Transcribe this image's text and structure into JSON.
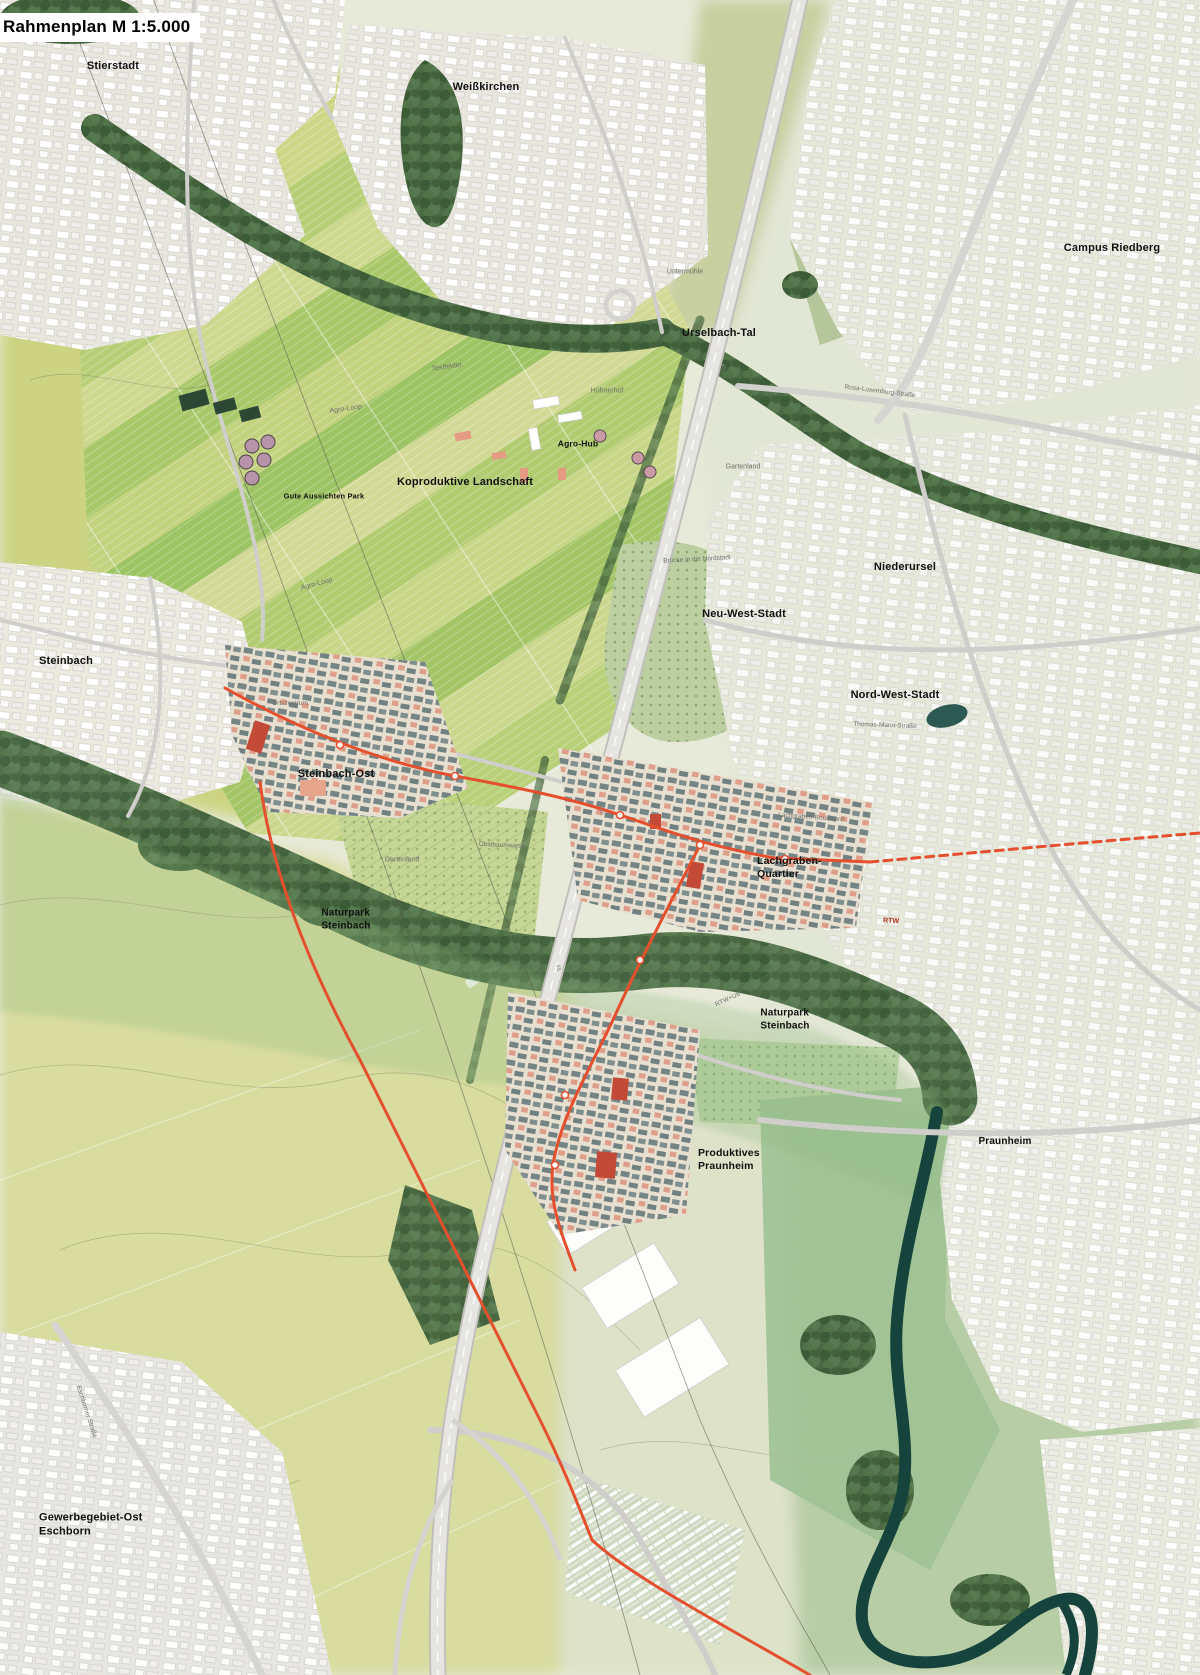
{
  "title": "Rahmenplan M 1:5.000",
  "colors": {
    "base": "#e8ead9",
    "fields_bright": "#b7cd72",
    "fields_pale": "#d6db9b",
    "urban": "#efeee8",
    "forest": "#4b6a43",
    "river": "#16443c",
    "rtw_line": "#e4502e",
    "quarter_building": "#6f7f80",
    "landmark_red": "#c24a37",
    "accent_salmon": "#dd9b85"
  },
  "map": {
    "labels": [
      {
        "id": "stierstadt",
        "kind": "place",
        "text": "Stierstadt",
        "x": 113,
        "y": 67,
        "size": 11
      },
      {
        "id": "weisskirchen",
        "kind": "place",
        "text": "Weißkirchen",
        "x": 486,
        "y": 88,
        "size": 11
      },
      {
        "id": "campus-riedberg",
        "kind": "place",
        "text": "Campus Riedberg",
        "x": 1112,
        "y": 249,
        "size": 11
      },
      {
        "id": "urselbach-tal",
        "kind": "place",
        "text": "Urselbach-Tal",
        "x": 719,
        "y": 334,
        "size": 11
      },
      {
        "id": "agro-hub",
        "kind": "place",
        "text": "Agro-Hub",
        "x": 578,
        "y": 444,
        "size": 8.5
      },
      {
        "id": "gute-aussichten-park",
        "kind": "place",
        "text": "Gute Aussichten Park",
        "x": 324,
        "y": 496,
        "size": 7.5
      },
      {
        "id": "koproduktive-landschaft",
        "kind": "place",
        "text": "Koproduktive Landschaft",
        "x": 465,
        "y": 483,
        "size": 11
      },
      {
        "id": "niederursel",
        "kind": "place",
        "text": "Niederursel",
        "x": 905,
        "y": 568,
        "size": 11
      },
      {
        "id": "neu-west-stadt",
        "kind": "place",
        "text": "Neu-West-Stadt",
        "x": 744,
        "y": 615,
        "size": 11
      },
      {
        "id": "nord-west-stadt",
        "kind": "place",
        "text": "Nord-West-Stadt",
        "x": 895,
        "y": 696,
        "size": 11
      },
      {
        "id": "steinbach",
        "kind": "place",
        "text": "Steinbach",
        "x": 66,
        "y": 662,
        "size": 11
      },
      {
        "id": "steinbach-ost",
        "kind": "place",
        "text": "Steinbach-Ost",
        "x": 336,
        "y": 775,
        "size": 11
      },
      {
        "id": "lachgraben-quartier",
        "kind": "place",
        "text": "Lachgraben-\nQuartier",
        "x": 757,
        "y": 868,
        "size": 10.5,
        "align": "left"
      },
      {
        "id": "naturpark-steinbach-1",
        "kind": "place",
        "text": "Naturpark\nSteinbach",
        "x": 346,
        "y": 920,
        "size": 10
      },
      {
        "id": "naturpark-steinbach-2",
        "kind": "place",
        "text": "Naturpark\nSteinbach",
        "x": 785,
        "y": 1020,
        "size": 10
      },
      {
        "id": "produktives-praunheim",
        "kind": "place",
        "text": "Produktives\nPraunheim",
        "x": 698,
        "y": 1160,
        "size": 10.5,
        "align": "left"
      },
      {
        "id": "praunheim",
        "kind": "place",
        "text": "Praunheim",
        "x": 1005,
        "y": 1142,
        "size": 10
      },
      {
        "id": "gewerbegebiet-ost-eschborn",
        "kind": "place",
        "text": "Gewerbegebiet-Ost\nEschborn",
        "x": 39,
        "y": 1525,
        "size": 11,
        "align": "left"
      },
      {
        "id": "untermuehle",
        "kind": "street",
        "text": "Untermühle",
        "x": 685,
        "y": 273,
        "size": 7
      },
      {
        "id": "agro-loop-1",
        "kind": "street",
        "text": "Agro-Loop",
        "x": 346,
        "y": 410,
        "size": 7,
        "rot": -8
      },
      {
        "id": "agro-loop-2",
        "kind": "street",
        "text": "Agro-Loop",
        "x": 317,
        "y": 585,
        "size": 7,
        "rot": -15
      },
      {
        "id": "testfelder",
        "kind": "street",
        "text": "Testfelder",
        "x": 447,
        "y": 368,
        "size": 7,
        "rot": -8
      },
      {
        "id": "huehnerhof",
        "kind": "street",
        "text": "Hühnerhof",
        "x": 607,
        "y": 392,
        "size": 7
      },
      {
        "id": "rosa-luxemburg-strasse",
        "kind": "street",
        "text": "Rosa-Luxemburg-Straße",
        "x": 880,
        "y": 392,
        "size": 6.5,
        "rot": 7
      },
      {
        "id": "bruecke-nordstadt",
        "kind": "street",
        "text": "Brücke in die Nordstadt",
        "x": 697,
        "y": 560,
        "size": 6.5,
        "rot": -3
      },
      {
        "id": "thomas-mann-strasse",
        "kind": "street",
        "text": "Thomas-Mann-Straße",
        "x": 885,
        "y": 726,
        "size": 6.5,
        "rot": 2
      },
      {
        "id": "gartenland-1",
        "kind": "street",
        "text": "Gartenland",
        "x": 402,
        "y": 861,
        "size": 7
      },
      {
        "id": "gartenland-2",
        "kind": "street",
        "text": "Gartenland",
        "x": 743,
        "y": 468,
        "size": 7
      },
      {
        "id": "obstbaumwiese",
        "kind": "street",
        "text": "Obstbaumwiese",
        "x": 502,
        "y": 846,
        "size": 6.5,
        "rot": 3
      },
      {
        "id": "lachgraben-boulevard",
        "kind": "street",
        "text": "Lachgraben-Boulevard",
        "x": 811,
        "y": 818,
        "size": 6.5,
        "rot": 4
      },
      {
        "id": "ortszentrum",
        "kind": "street",
        "text": "Ortszentrum",
        "x": 290,
        "y": 704,
        "size": 6.5
      },
      {
        "id": "eschborner-strasse",
        "kind": "street",
        "text": "Eschborner Straße",
        "x": 86,
        "y": 1412,
        "size": 6.5,
        "rot": 72
      },
      {
        "id": "rtw-u6",
        "kind": "street",
        "text": "RTW+U6",
        "x": 728,
        "y": 1000,
        "size": 6.5,
        "rot": -25
      },
      {
        "id": "rtw",
        "kind": "street-red",
        "text": "RTW",
        "x": 891,
        "y": 922,
        "size": 7,
        "rot": 3
      },
      {
        "id": "a5-marker-1",
        "kind": "shield",
        "text": "45",
        "x": 722,
        "y": 367,
        "size": 6,
        "rot": 78
      },
      {
        "id": "a5-marker-2",
        "kind": "shield",
        "text": "45",
        "x": 600,
        "y": 812,
        "size": 6,
        "rot": 80
      },
      {
        "id": "a5-marker-3",
        "kind": "shield",
        "text": "45",
        "x": 557,
        "y": 968,
        "size": 6,
        "rot": 80
      }
    ]
  }
}
